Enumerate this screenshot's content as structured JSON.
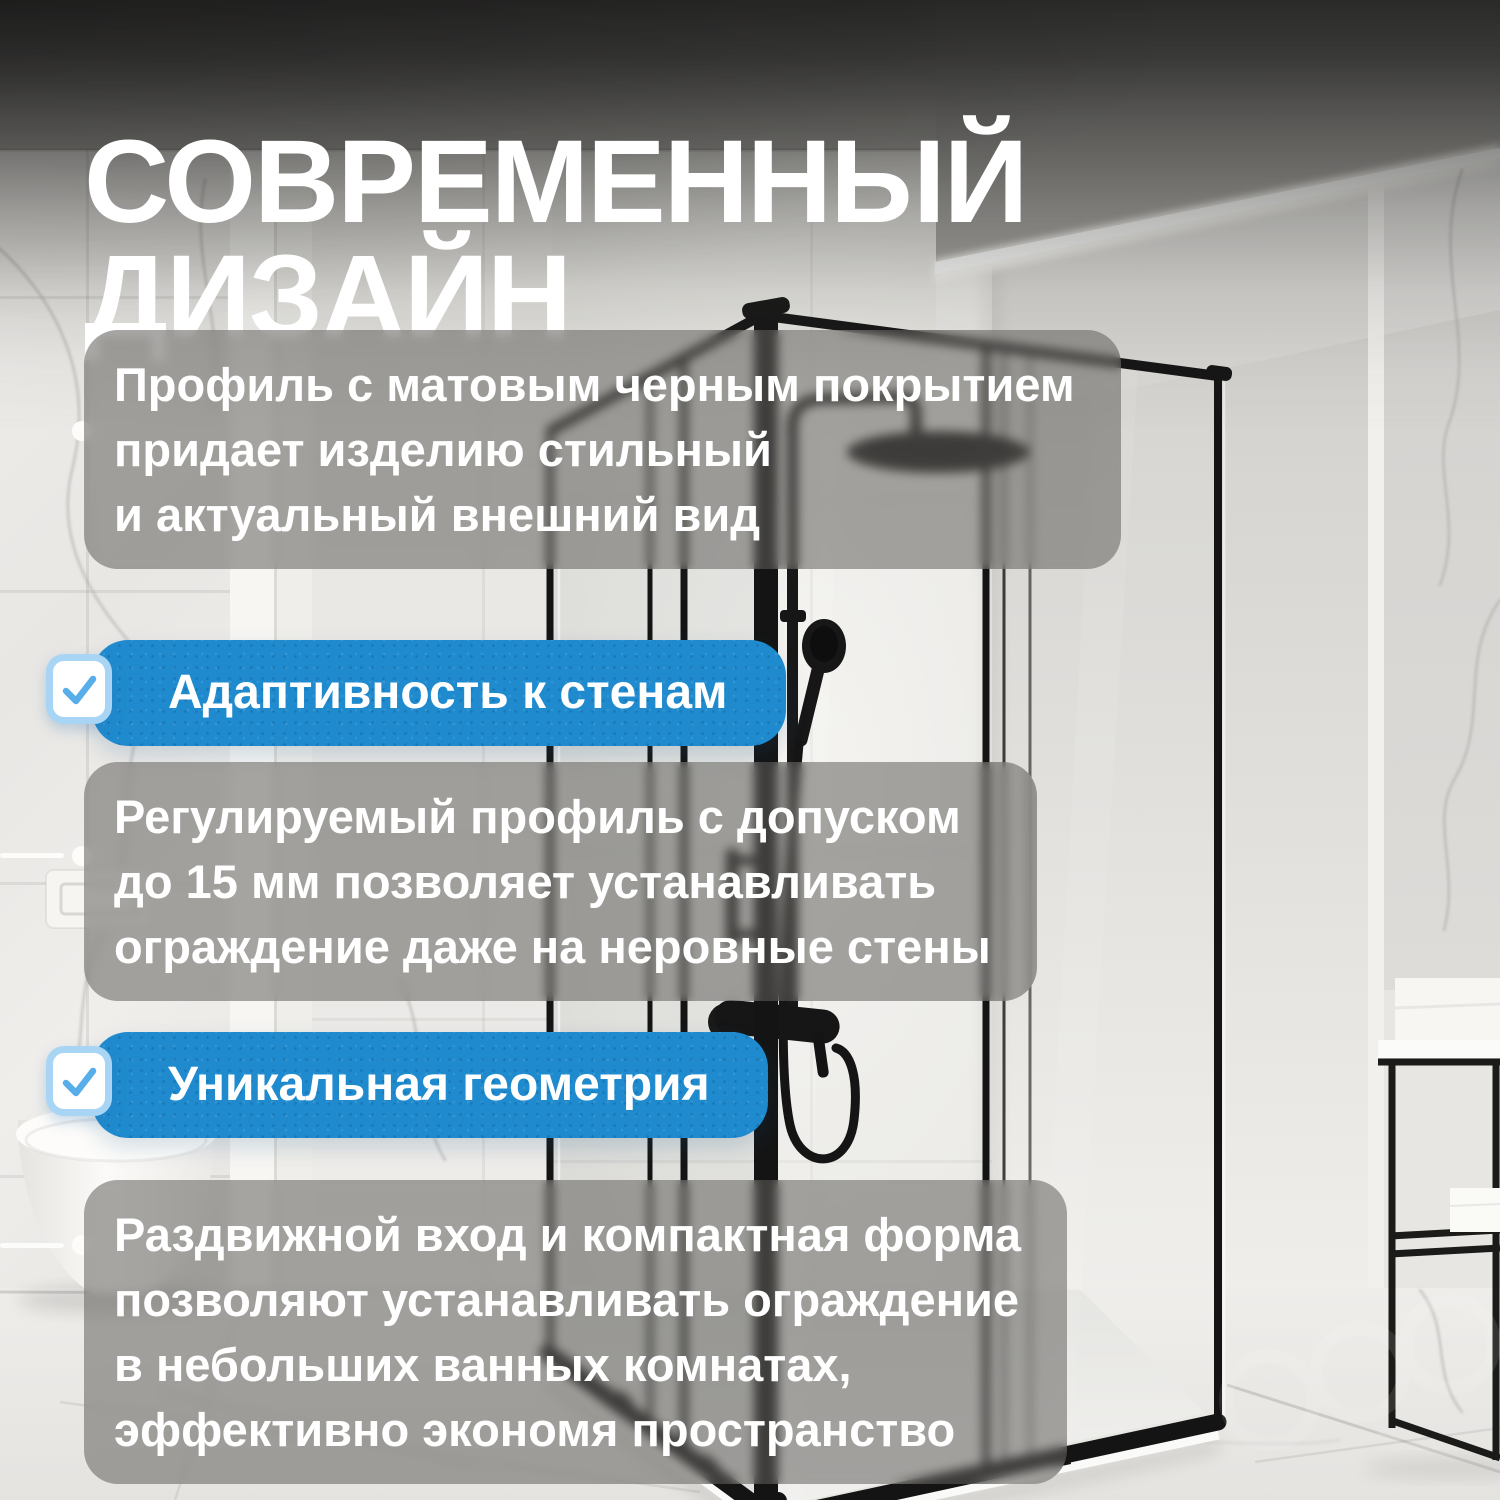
{
  "title": {
    "line1": "СОВРЕМЕННЫЙ",
    "line2": "ДИЗАЙН"
  },
  "features": {
    "para1": {
      "lines": [
        "Профиль с матовым черным покрытием",
        "придает изделию стильный",
        "и актуальный внешний вид"
      ]
    },
    "badge1": {
      "label": "Адаптивность к стенам"
    },
    "para2": {
      "lines": [
        "Регулируемый профиль с допуском",
        "до 15 мм позволяет устанавливать",
        "ограждение даже на неровные стены"
      ]
    },
    "badge2": {
      "label": "Уникальная геометрия"
    },
    "para3": {
      "lines": [
        "Раздвижной вход и компактная форма",
        "позволяют устанавливать ограждение",
        "в небольших ванных комнатах,",
        "эффективно экономя пространство"
      ]
    }
  },
  "icons": {
    "badge_check": "✓",
    "bullet_dot": "•"
  },
  "colors": {
    "accent_blue": "#1f8bce",
    "checkbox_border": "#a9d5f5",
    "check_stroke": "#57aee9",
    "text_white": "#ffffff",
    "overlay_gray": "rgba(98,96,93,0.55)",
    "frame_black": "#161616"
  }
}
